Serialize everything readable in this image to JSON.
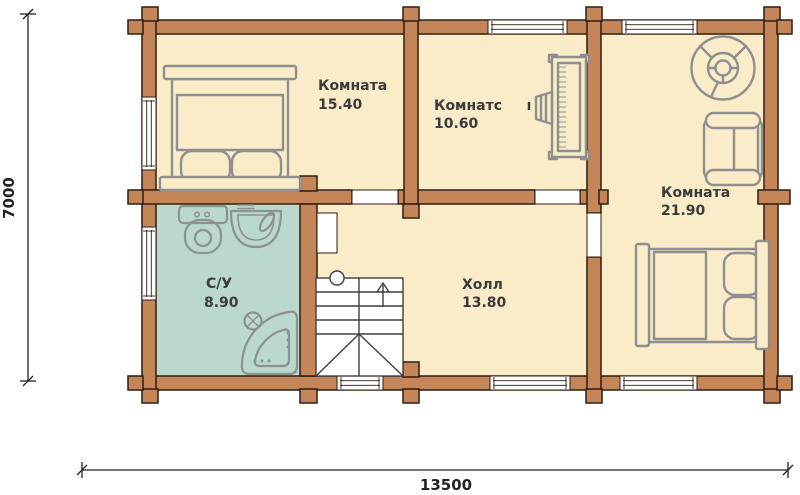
{
  "plan": {
    "type": "floor-plan",
    "rooms": [
      {
        "name": "Комната",
        "area": "15.40"
      },
      {
        "name": "Комнатс",
        "area": "10.60"
      },
      {
        "name": "Комната",
        "area": "21.90"
      },
      {
        "name": "С/У",
        "area": "8.90"
      },
      {
        "name": "Холл",
        "area": "13.80"
      }
    ],
    "dimensions": {
      "width": "13500",
      "height": "7000"
    },
    "colors": {
      "wall": "#c48558",
      "wall_outline": "#2f1d10",
      "floor": "#faecc8",
      "bathroom_floor": "#bad8cc",
      "furniture": "#8f8f8f",
      "fixtures": "#8a938f",
      "stairs": "#3f3f3f",
      "text": "#3b3b3b"
    },
    "icons": {
      "bed_room1": "double-bed-top-view",
      "bed_room3": "double-bed-top-view",
      "piano": "piano-with-stool",
      "round_table": "round-table",
      "armchair": "armchair",
      "toilet": "toilet",
      "sink": "washbasin",
      "shower": "corner-shower",
      "stairs": "staircase-up-arrow"
    }
  }
}
